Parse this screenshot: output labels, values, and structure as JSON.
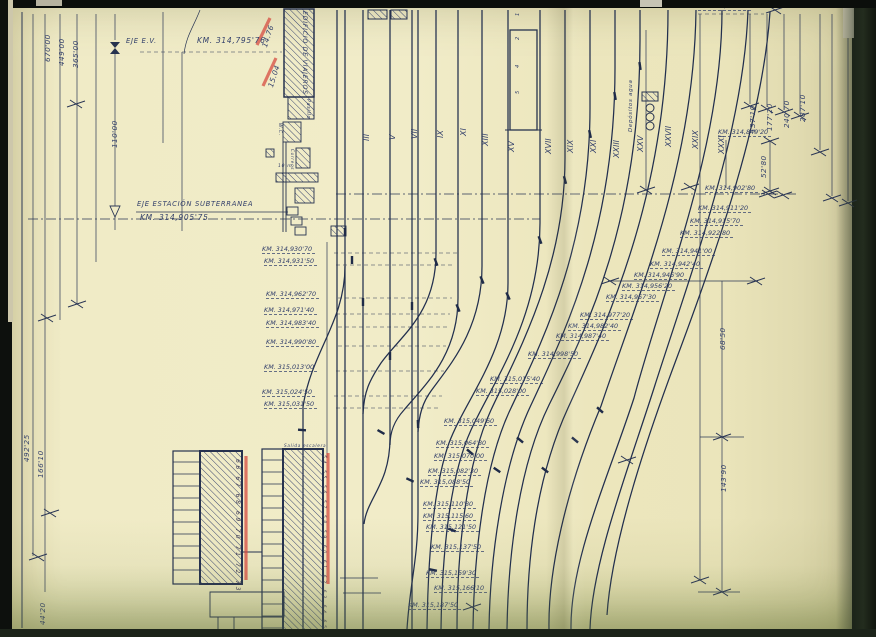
{
  "colors": {
    "paper": "#f0ebc6",
    "ink": "#27334f",
    "handwriting": "#33406b",
    "red_marker": "#d6453c"
  },
  "drawing_title_labels": {
    "station_axis": "EJE ESTACIÓN SUBTERRANEA",
    "station_axis_km": "KM. 314,905'75",
    "track_axis": "EJE E.V.",
    "track_axis_km": "KM. 314,795'76"
  },
  "annotations": {
    "dims": [
      {
        "t": "670'00",
        "x": 44,
        "y": 62
      },
      {
        "t": "449'00",
        "x": 58,
        "y": 66
      },
      {
        "t": "365'00",
        "x": 72,
        "y": 68
      },
      {
        "t": "110'00",
        "x": 111,
        "y": 148
      },
      {
        "t": "492'25",
        "x": 23,
        "y": 462
      },
      {
        "t": "166'10",
        "x": 37,
        "y": 478
      },
      {
        "t": "44'20",
        "x": 39,
        "y": 625
      },
      {
        "t": "287'10",
        "x": 799,
        "y": 122
      },
      {
        "t": "240'70",
        "x": 783,
        "y": 128
      },
      {
        "t": "177'20",
        "x": 766,
        "y": 131
      },
      {
        "t": "137'10",
        "x": 749,
        "y": 133
      },
      {
        "t": "52'80",
        "x": 760,
        "y": 178
      },
      {
        "t": "68'50",
        "x": 719,
        "y": 350
      },
      {
        "t": "143'90",
        "x": 720,
        "y": 492
      },
      {
        "t": "14.76",
        "x": 261,
        "y": 46,
        "r": -72
      },
      {
        "t": "15.04",
        "x": 267,
        "y": 86,
        "r": -72
      }
    ],
    "km": [
      {
        "t": "KM. 314,764'90",
        "x": 698,
        "y": 3
      },
      {
        "t": "KM. 314,849'20",
        "x": 718,
        "y": 129
      },
      {
        "t": "KM. 314,902'80",
        "x": 705,
        "y": 185
      },
      {
        "t": "KM. 314,911'20",
        "x": 698,
        "y": 205
      },
      {
        "t": "KM. 314,915'70",
        "x": 690,
        "y": 218
      },
      {
        "t": "KM. 314,922'80",
        "x": 680,
        "y": 230
      },
      {
        "t": "KM. 314,941'00",
        "x": 662,
        "y": 248
      },
      {
        "t": "KM. 314,942'40",
        "x": 650,
        "y": 261
      },
      {
        "t": "KM. 314,946'90",
        "x": 634,
        "y": 272
      },
      {
        "t": "KM. 314,956'20",
        "x": 622,
        "y": 283
      },
      {
        "t": "KM. 314,967'30",
        "x": 606,
        "y": 294
      },
      {
        "t": "KM. 314,977'20",
        "x": 580,
        "y": 312
      },
      {
        "t": "KM. 314,982'40",
        "x": 568,
        "y": 323
      },
      {
        "t": "KM. 314,987'40",
        "x": 556,
        "y": 333
      },
      {
        "t": "KM. 314,998'50",
        "x": 528,
        "y": 351
      },
      {
        "t": "KM. 315,015'40",
        "x": 490,
        "y": 376
      },
      {
        "t": "KM. 315,028'00",
        "x": 476,
        "y": 388
      },
      {
        "t": "KM. 315,049'60",
        "x": 444,
        "y": 418
      },
      {
        "t": "KM. 315,064'80",
        "x": 436,
        "y": 440
      },
      {
        "t": "KM. 315,070'00",
        "x": 434,
        "y": 453
      },
      {
        "t": "KM. 315,082'30",
        "x": 428,
        "y": 468
      },
      {
        "t": "KM. 315,088'50",
        "x": 420,
        "y": 479
      },
      {
        "t": "KM. 315,110'80",
        "x": 423,
        "y": 501
      },
      {
        "t": "KM. 315,115'60",
        "x": 423,
        "y": 513
      },
      {
        "t": "KM. 315,121'50",
        "x": 426,
        "y": 524
      },
      {
        "t": "KM. 315,137'50",
        "x": 431,
        "y": 544
      },
      {
        "t": "KM. 315,159'30",
        "x": 426,
        "y": 570
      },
      {
        "t": "KM. 315,166'10",
        "x": 434,
        "y": 585
      },
      {
        "t": "KM. 315,187'50",
        "x": 408,
        "y": 602
      },
      {
        "t": "KM. 314,930'70",
        "x": 262,
        "y": 246
      },
      {
        "t": "KM. 314,931'50",
        "x": 264,
        "y": 258
      },
      {
        "t": "KM. 314,962'70",
        "x": 266,
        "y": 291
      },
      {
        "t": "KM. 314,971'40",
        "x": 264,
        "y": 307
      },
      {
        "t": "KM. 314,983'40",
        "x": 266,
        "y": 320
      },
      {
        "t": "KM. 314,990'80",
        "x": 266,
        "y": 339
      },
      {
        "t": "KM. 315,013'00",
        "x": 264,
        "y": 364
      },
      {
        "t": "KM. 315,024'50",
        "x": 262,
        "y": 389
      },
      {
        "t": "KM. 315,031'50",
        "x": 264,
        "y": 401
      }
    ],
    "axis": [
      {
        "t": "EJE E.V.",
        "x": 126,
        "y": 38
      },
      {
        "t": "KM. 314,795'76",
        "x": 197,
        "y": 37,
        "s": 7.5
      },
      {
        "t": "EJE ESTACIÓN SUBTERRANEA",
        "x": 137,
        "y": 201
      },
      {
        "t": "KM. 314,905'75",
        "x": 140,
        "y": 214,
        "s": 7.5
      }
    ],
    "roman": [
      {
        "t": "III",
        "x": 363,
        "y": 141
      },
      {
        "t": "V",
        "x": 389,
        "y": 140
      },
      {
        "t": "VII",
        "x": 411,
        "y": 139
      },
      {
        "t": "IX",
        "x": 437,
        "y": 138
      },
      {
        "t": "XI",
        "x": 460,
        "y": 136
      },
      {
        "t": "XIII",
        "x": 482,
        "y": 146
      },
      {
        "t": "XV",
        "x": 508,
        "y": 152
      },
      {
        "t": "XVII",
        "x": 545,
        "y": 154
      },
      {
        "t": "XIX",
        "x": 567,
        "y": 153
      },
      {
        "t": "XXI",
        "x": 590,
        "y": 153
      },
      {
        "t": "XXIII",
        "x": 613,
        "y": 158
      },
      {
        "t": "XXV",
        "x": 637,
        "y": 152
      },
      {
        "t": "XXVII",
        "x": 665,
        "y": 147
      },
      {
        "t": "XXIX",
        "x": 692,
        "y": 149
      },
      {
        "t": "XXXI",
        "x": 718,
        "y": 154
      }
    ],
    "digits": [
      {
        "t": "1",
        "x": 516,
        "y": 16
      },
      {
        "t": "2",
        "x": 516,
        "y": 40
      },
      {
        "t": "4",
        "x": 516,
        "y": 68
      },
      {
        "t": "5",
        "x": 516,
        "y": 94
      }
    ],
    "bld": [
      {
        "t": "EDIFICIO DE VIAJEROS",
        "x": 307,
        "y": 11,
        "r": 90
      },
      {
        "t": "Pasillo",
        "x": 309,
        "y": 99,
        "r": 90,
        "s": 4.8
      },
      {
        "t": "W.C.",
        "x": 281,
        "y": 123,
        "r": 90,
        "s": 4.5
      },
      {
        "t": "Correos",
        "x": 294,
        "y": 149,
        "r": 90,
        "s": 4.2
      },
      {
        "t": "10 m.",
        "x": 278,
        "y": 165,
        "r": 0,
        "s": 4.5
      },
      {
        "t": "Depósitos agua",
        "x": 629,
        "y": 132,
        "r": -90,
        "s": 5.5
      },
      {
        "t": "Salida escalera",
        "x": 284,
        "y": 444,
        "r": 0,
        "s": 4.2
      }
    ],
    "seq": [
      {
        "t": "66 67 68 69 70 71 72 73",
        "x": 240,
        "y": 459,
        "r": 90
      },
      {
        "t": "54 55 56 57 58 59 60 61 62 63 64 65",
        "x": 325,
        "y": 455,
        "r": 90,
        "s": 4.5
      }
    ]
  }
}
